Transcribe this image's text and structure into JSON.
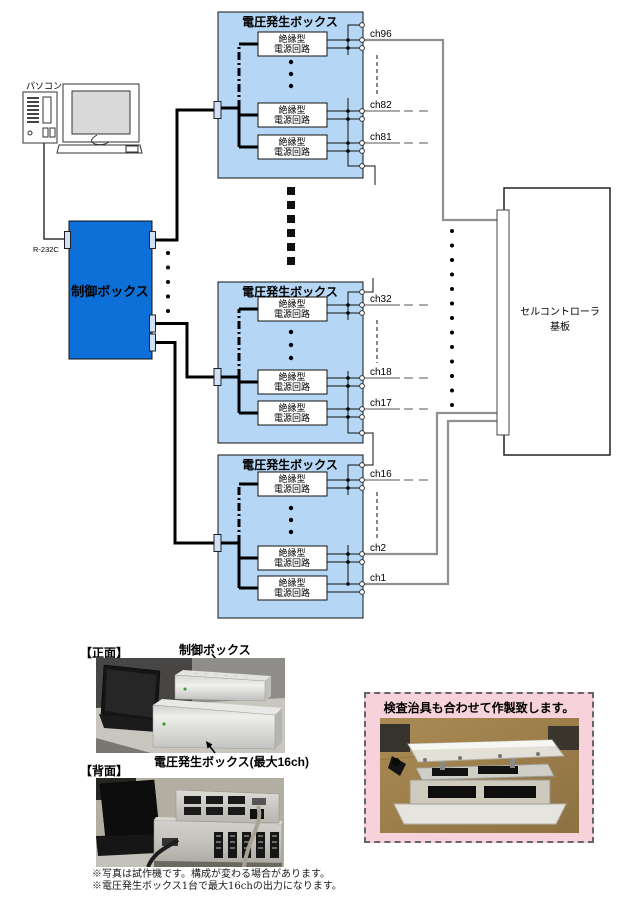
{
  "diagram": {
    "pc_label": "パソコン",
    "rs232c_label": "R-232C",
    "control_box_label": "制御ボックス",
    "voltage_box_title": "電圧発生ボックス",
    "circuit_label_line1": "絶縁型",
    "circuit_label_line2": "電源回路",
    "controller_label_line1": "セルコントローラ",
    "controller_label_line2": "基板",
    "channels": [
      "ch96",
      "ch82",
      "ch81",
      "ch32",
      "ch18",
      "ch17",
      "ch16",
      "ch2",
      "ch1"
    ]
  },
  "photos": {
    "front_section_label": "【正面】",
    "back_section_label": "【背面】",
    "control_box_caption": "制御ボックス",
    "voltage_box_caption": "電圧発生ボックス(最大16ch)",
    "jig_banner": "検査治具も合わせて作製致します。"
  },
  "notes": [
    "※写真は試作機です。構成が変わる場合があります。",
    "※電圧発生ボックス1台で最大16chの出力になります。"
  ],
  "colors": {
    "voltage_box_fill": "#b5d7f5",
    "control_box_fill": "#0c70d8",
    "connector_fill": "#cfe2f7",
    "pink_panel_fill": "#f7d2da",
    "wire_gray": "#909090"
  }
}
